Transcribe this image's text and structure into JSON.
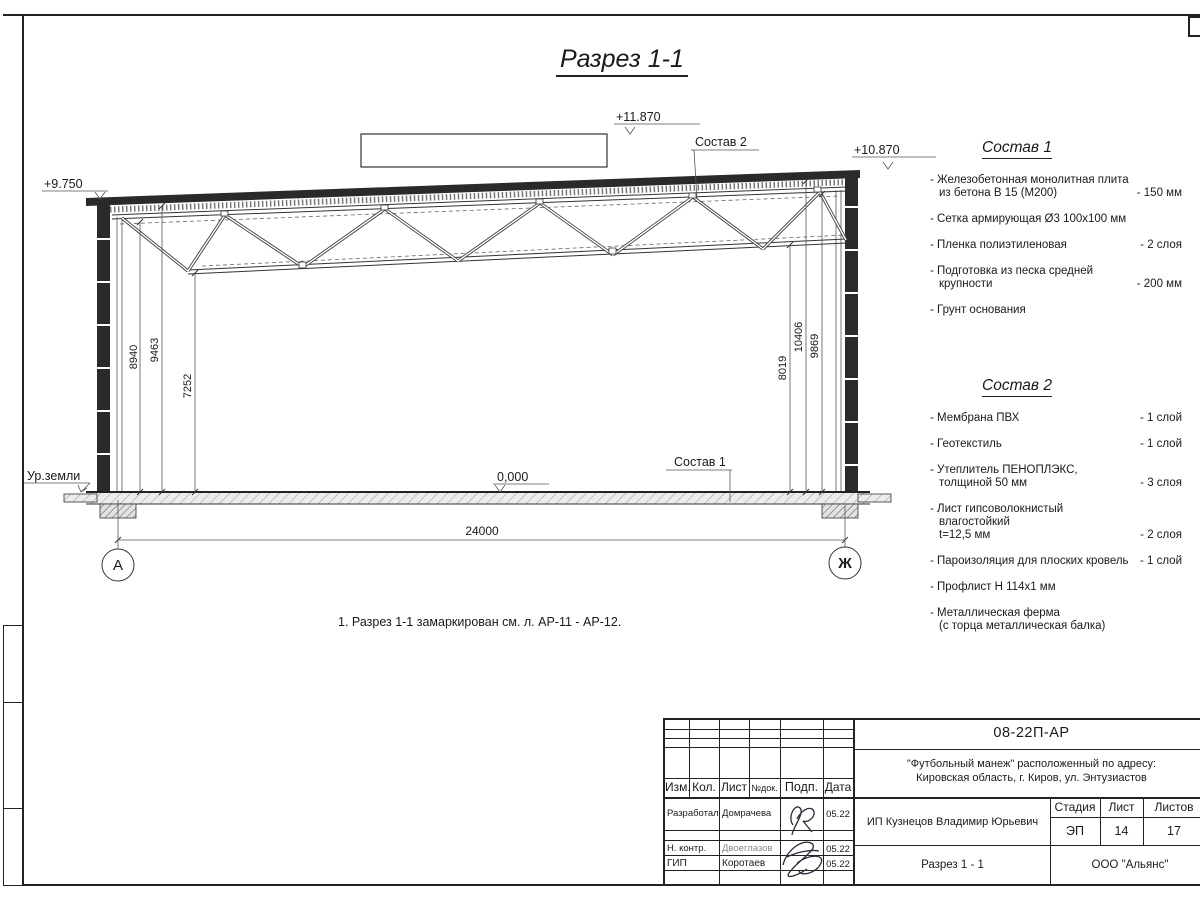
{
  "page": {
    "title": "Разрез 1-1",
    "note": "1. Разрез 1-1 замаркирован см. л. АР-11 - АР-12."
  },
  "drawing": {
    "elevations": {
      "roof_left": "+9.750",
      "box_top": "+11.870",
      "roof_right": "+10.870",
      "floor": "0,000"
    },
    "ground_label": "Ур.земли",
    "callout_sostav1": "Состав 1",
    "callout_sostav2": "Состав 2",
    "dims": {
      "left": [
        "8940",
        "9463",
        "7252"
      ],
      "right": [
        "8019",
        "10406",
        "9869"
      ],
      "span": "24000"
    },
    "axis_left": "А",
    "axis_right": "Ж"
  },
  "sostav1": {
    "title": "Состав 1",
    "items": [
      {
        "text": "- Железобетонная  монолитная плита\nиз бетона В 15 (М200)",
        "qty": "- 150 мм"
      },
      {
        "text": "- Сетка армирующая Ø3 100x100 мм",
        "qty": ""
      },
      {
        "text": "- Пленка полиэтиленовая",
        "qty": "-  2 слоя"
      },
      {
        "text": "- Подготовка из песка средней\nкрупности",
        "qty": "- 200 мм"
      },
      {
        "text": "- Грунт основания",
        "qty": ""
      }
    ]
  },
  "sostav2": {
    "title": "Состав 2",
    "items": [
      {
        "text": "- Мембрана ПВХ",
        "qty": "- 1 слой"
      },
      {
        "text": "- Геотекстиль",
        "qty": "- 1 слой"
      },
      {
        "text": "- Утеплитель ПЕНОПЛЭКС,\nтолщиной 50 мм",
        "qty": "- 3 слоя"
      },
      {
        "text": "- Лист гипсоволокнистый влагостойкий\nt=12,5 мм",
        "qty": "- 2 слоя"
      },
      {
        "text": "- Пароизоляция для плоских кровель",
        "qty": "- 1 слой"
      },
      {
        "text": "- Профлист Н 114х1 мм",
        "qty": ""
      },
      {
        "text": "- Металлическая ферма\n(с торца металлическая балка)",
        "qty": ""
      }
    ]
  },
  "titleblock": {
    "doc_code": "08-22П-АР",
    "project_line1": "\"Футбольный манеж\" расположенный по адресу:",
    "project_line2": "Кировская область, г. Киров, ул. Энтузиастов",
    "client": "ИП Кузнецов Владимир Юрьевич",
    "sheet_title": "Разрез 1 - 1",
    "company": "ООО \"Альянс\"",
    "stage_label": "Стадия",
    "sheet_label": "Лист",
    "sheets_label": "Листов",
    "stage": "ЭП",
    "sheet": "14",
    "sheets": "17",
    "cols": {
      "izm": "Изм.",
      "kol": "Кол.",
      "list": "Лист",
      "ndok": "№док.",
      "podp": "Подп.",
      "data": "Дата"
    },
    "rows": [
      {
        "role": "Разработал",
        "name": "Домрачева",
        "date": "05.22"
      },
      {
        "role": "Н. контр.",
        "name": "Двоеглазов",
        "date": "05.22"
      },
      {
        "role": "ГИП",
        "name": "Коротаев",
        "date": "05.22"
      }
    ]
  }
}
